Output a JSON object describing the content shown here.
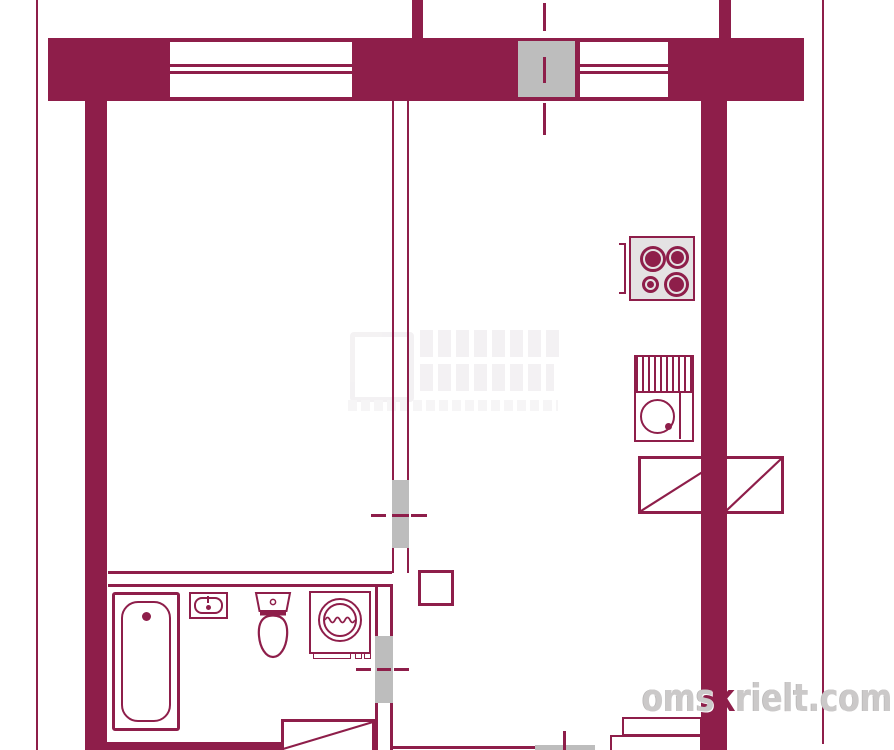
{
  "colors": {
    "wall": "#8e1e4a",
    "opening_gray": "#bdbdbd",
    "stove_background": "#e4e2e3",
    "paper": "#ffffff",
    "watermark_text_gray": "#cbc9c9"
  },
  "watermark_site": {
    "prefix": "oms",
    "highlight": "к",
    "suffix": "rielt.com"
  },
  "fixture_icon_names": [
    "window-icon",
    "ventilation-shaft-icon",
    "axis-line-icon",
    "door-opening-icon",
    "bathtub-icon",
    "wash-basin-icon",
    "toilet-icon",
    "washing-machine-icon",
    "gas-stove-icon",
    "kitchen-sink-icon",
    "kitchen-counter-icon",
    "wardrobe-icon",
    "entry-steps-icon",
    "column-icon"
  ]
}
